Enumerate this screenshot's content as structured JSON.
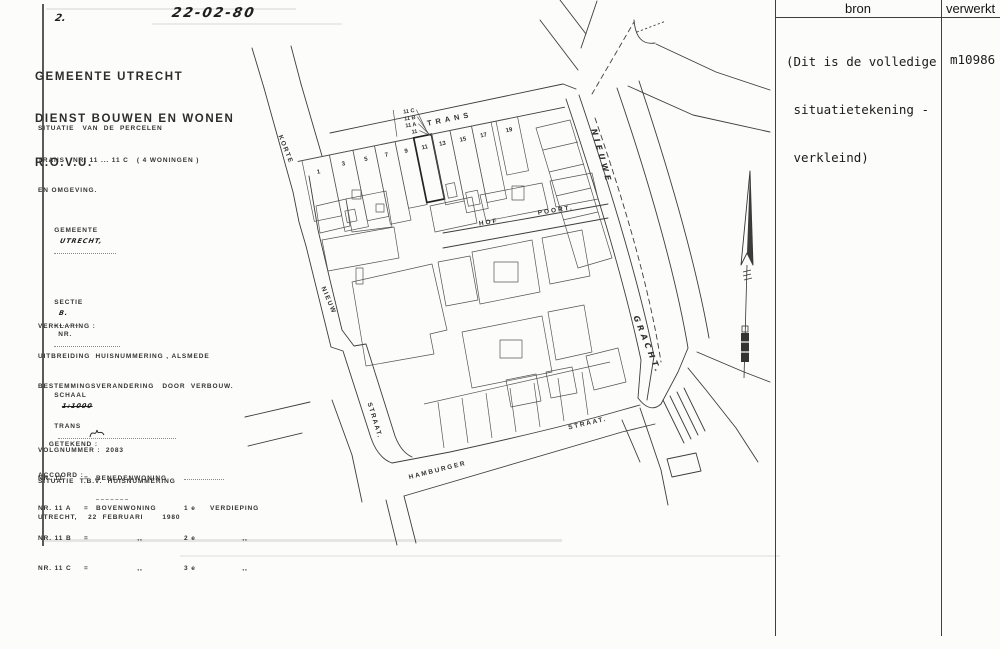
{
  "scan": {
    "page_note": "2.",
    "date_stamp": "22-02-80"
  },
  "letterhead": {
    "line1": "GEMEENTE UTRECHT",
    "line2": "DIENST BOUWEN EN WONEN",
    "line3": "R.O.V.U."
  },
  "situation": {
    "line1": "SITUATIE   VAN  DE  PERCELEN",
    "line2": "TRANS   NR. 11 ... 11 C   ( 4 WONINGEN )",
    "line3": "EN OMGEVING.",
    "gemeente_label": "GEMEENTE",
    "gemeente_value": "UTRECHT,",
    "sectie_label": "SECTIE",
    "sectie_value": "B.",
    "nr_label": "NR.",
    "schaal_label": "SCHAAL",
    "schaal_value": "1:1000",
    "volgnummer": "VOLGNUMMER :  2083",
    "purpose": "SITUATIE  T.B.V.  HUISNUMMERING"
  },
  "verklaring": {
    "title": "VERKLARING :",
    "line1": "UITBREIDING  HUISNUMMERING , ALSMEDE",
    "line2": "BESTEMMINGSVERANDERING   DOOR  VERBOUW.",
    "trans_label": "TRANS",
    "rows": [
      {
        "nr": "NR. 11",
        "eq": "=",
        "desc": "BENEDENWONING",
        "floor": "",
        "suffix": ""
      },
      {
        "nr": "NR. 11 A",
        "eq": "=",
        "desc": "BOVENWONING",
        "floor": "1 e",
        "suffix": "VERDIEPING"
      },
      {
        "nr": "NR. 11 B",
        "eq": "=",
        "desc": ",,",
        "floor": "2 e",
        "suffix": ",,"
      },
      {
        "nr": "NR. 11 C",
        "eq": "=",
        "desc": ",,",
        "floor": "3 e",
        "suffix": ",,"
      }
    ]
  },
  "signoff": {
    "getekend_label": "GETEKEND :",
    "accoord_label": "ACCOORD :",
    "place_date": "UTRECHT,    22  FEBRUARI       1980"
  },
  "map": {
    "street_labels": {
      "korte": "KORTE",
      "trans": "TRANS",
      "nieuw": "NIEUW",
      "straat_left": "STRAAT.",
      "hof": "HOF",
      "poort": "POORT.",
      "nieuwe": "NIEUWE",
      "gracht": "GRACHT.",
      "hamburger": "HAMBURGER",
      "straat_bottom": "STRAAT."
    },
    "parcel_numbers": [
      "1",
      "3",
      "5",
      "7",
      "9",
      "11",
      "13",
      "15",
      "17",
      "19"
    ],
    "house_number_stack": [
      "11 C",
      "11 B",
      "11 A",
      "11"
    ]
  },
  "ledger": {
    "col_bron": "bron",
    "col_verwerkt": "verwerkt",
    "note_lines": [
      "(Dit is de volledige",
      " situatietekening -",
      " verkleind)"
    ],
    "verwerkt_value": "m10986"
  }
}
